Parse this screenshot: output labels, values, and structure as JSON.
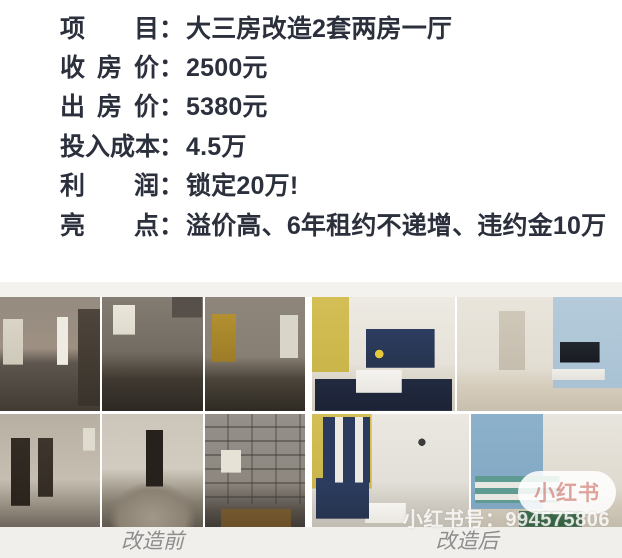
{
  "stats": {
    "separator": "：",
    "rows": [
      {
        "label": "项目",
        "value": "大三房改造2套两房一厅"
      },
      {
        "label": "收房价",
        "value": "2500元"
      },
      {
        "label": "出房价",
        "value": "5380元"
      },
      {
        "label": "投入成本",
        "value": "4.5万"
      },
      {
        "label": "利润",
        "value": "锁定20万!"
      },
      {
        "label": "亮点",
        "value": "溢价高、6年租约不递增、违约金10万"
      }
    ]
  },
  "collage": {
    "before_caption": "改造前",
    "after_caption": "改造后",
    "before_photos": [
      "gutted-living-room",
      "dark-stripped-room",
      "room-with-yellow-cabinet",
      "wall-with-broken-door-openings",
      "rubble-pile-room",
      "concrete-block-wall-room"
    ],
    "after_photos": [
      "living-room-navy-sofa-yellow-wall",
      "hallway-with-tv-blue-wall",
      "living-room-navy-curtains",
      "bedroom-blue-striped-wall"
    ]
  },
  "watermark": {
    "brand_pill": "小红书",
    "account_line": "小红书号：994575806"
  },
  "colors": {
    "stats_text": "#2b303c",
    "caption_text": "#8d8d8d",
    "caption_strip": "#f0efec",
    "brand_watermark": "#dfa09a",
    "after_yellow_wall": "#d3bf55",
    "after_navy_sofa": "#2d3d60",
    "after_blue_wall": "#a9c2d4"
  }
}
